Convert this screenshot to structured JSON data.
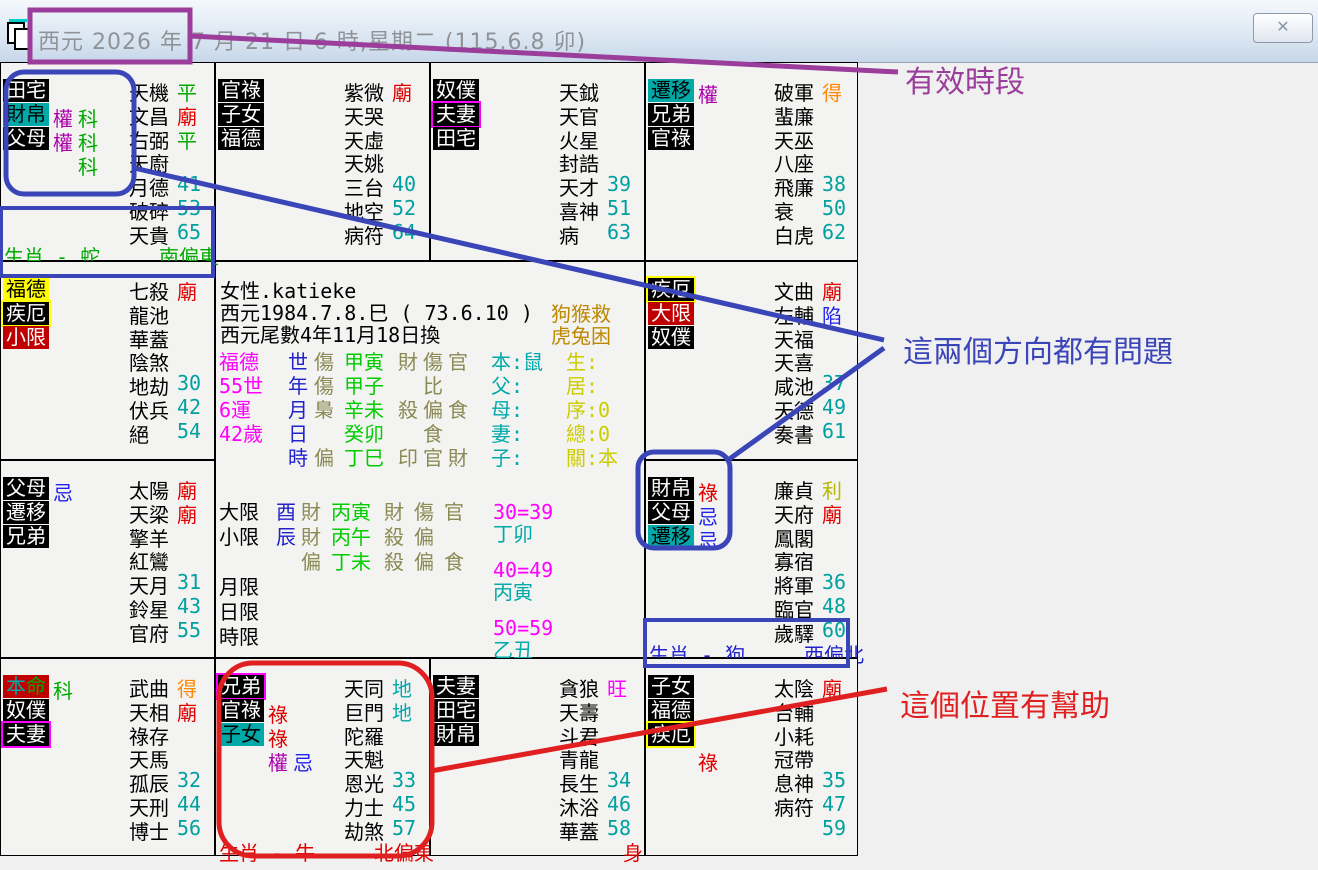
{
  "window": {
    "title": "西元 2026 年 7 月 21 日 6 時,星期二 (115.6.8 卯)",
    "close_label": "✕"
  },
  "annotations": {
    "valid_period": "有效時段",
    "directions_problem": "這兩個方向都有問題",
    "position_help": "這個位置有幫助"
  },
  "colors": {
    "badge_teal": "#00a8a8",
    "badge_red": "#c00000",
    "badge_yellow": "#ffff00",
    "temple_red": "#e00000",
    "wang_magenta": "#ff00ff",
    "de_orange": "#ff8800",
    "li_olive": "#b8b800",
    "ping_green": "#00aa00",
    "xian_blue": "#2222ee",
    "number_teal": "#00a0a0",
    "mark_lu": "#e00000",
    "mark_quan": "#aa00aa",
    "mark_ke": "#00aa00",
    "mark_ji": "#2222ee",
    "annotation_purple": "#9b3d9b",
    "annotation_blue": "#3a45b8",
    "annotation_red": "#e02020"
  },
  "palaces": [
    {
      "id": "si",
      "col": 0,
      "row": 0,
      "badges": [
        {
          "t": "田宅",
          "s": "black"
        },
        {
          "t": "財帛",
          "s": "teal"
        },
        {
          "t": "父母",
          "s": "black"
        }
      ],
      "marks": [
        [],
        [
          {
            "t": "權",
            "c": "pu",
            "col": 0
          },
          {
            "t": "科",
            "c": "gr",
            "col": 1
          }
        ],
        [
          {
            "t": "權",
            "c": "pu",
            "col": 0
          },
          {
            "t": "科",
            "c": "gr",
            "col": 1
          }
        ],
        [
          {
            "t": "科",
            "c": "gr",
            "col": 1
          }
        ]
      ],
      "stars": [
        {
          "n": "天機",
          "x": "平",
          "c": "gr"
        },
        {
          "n": "文昌",
          "x": "廟",
          "c": "re"
        },
        {
          "n": "右弼",
          "x": "平",
          "c": "gr"
        },
        {
          "n": "天廚"
        },
        {
          "n": "月德",
          "x": "41",
          "c": "nu"
        },
        {
          "n": "破碎",
          "x": "53",
          "c": "nu"
        },
        {
          "n": "天貴",
          "x": "65",
          "c": "nu"
        }
      ],
      "corner": {
        "left": "生肖 - 蛇",
        "right": "南偏東",
        "c": "gr"
      }
    },
    {
      "id": "wu",
      "col": 1,
      "row": 0,
      "badges": [
        {
          "t": "官祿",
          "s": "black"
        },
        {
          "t": "子女",
          "s": "black"
        },
        {
          "t": "福德",
          "s": "black"
        }
      ],
      "marks": [],
      "stars": [
        {
          "n": "紫微",
          "x": "廟",
          "c": "re"
        },
        {
          "n": "天哭"
        },
        {
          "n": "天虛"
        },
        {
          "n": "天姚"
        },
        {
          "n": "三台",
          "x": "40",
          "c": "nu"
        },
        {
          "n": "地空",
          "x": "52",
          "c": "nu"
        },
        {
          "n": "病符",
          "x": "64",
          "c": "nu"
        }
      ]
    },
    {
      "id": "wei",
      "col": 2,
      "row": 0,
      "badges": [
        {
          "t": "奴僕",
          "s": "black"
        },
        {
          "t": "夫妻",
          "s": "black-mb"
        },
        {
          "t": "田宅",
          "s": "black"
        }
      ],
      "marks": [],
      "stars": [
        {
          "n": "天鉞"
        },
        {
          "n": "天官"
        },
        {
          "n": "火星"
        },
        {
          "n": "封誥"
        },
        {
          "n": "天才",
          "x": "39",
          "c": "nu"
        },
        {
          "n": "喜神",
          "x": "51",
          "c": "nu"
        },
        {
          "n": "病",
          "x": "63",
          "c": "nu"
        }
      ]
    },
    {
      "id": "shen",
      "col": 3,
      "row": 0,
      "badges": [
        {
          "t": "遷移",
          "s": "teal"
        },
        {
          "t": "兄弟",
          "s": "black"
        },
        {
          "t": "官祿",
          "s": "black"
        }
      ],
      "marks": [
        [
          {
            "t": "權",
            "c": "pu",
            "col": 0
          }
        ]
      ],
      "stars": [
        {
          "n": "破軍",
          "x": "得",
          "c": "or"
        },
        {
          "n": "蜚廉"
        },
        {
          "n": "天巫"
        },
        {
          "n": "八座"
        },
        {
          "n": "飛廉",
          "x": "38",
          "c": "nu"
        },
        {
          "n": "衰",
          "x": "50",
          "c": "nu"
        },
        {
          "n": "白虎",
          "x": "62",
          "c": "nu"
        }
      ]
    },
    {
      "id": "chen",
      "col": 0,
      "row": 1,
      "badges": [
        {
          "t": "福德",
          "s": "yellow"
        },
        {
          "t": "疾厄",
          "s": "black-yb"
        },
        {
          "t": "小限",
          "s": "red"
        }
      ],
      "marks": [],
      "stars": [
        {
          "n": "七殺",
          "x": "廟",
          "c": "re"
        },
        {
          "n": "龍池"
        },
        {
          "n": "華蓋"
        },
        {
          "n": "陰煞"
        },
        {
          "n": "地劫",
          "x": "30",
          "c": "nu"
        },
        {
          "n": "伏兵",
          "x": "42",
          "c": "nu"
        },
        {
          "n": "絕",
          "x": "54",
          "c": "nu"
        }
      ]
    },
    {
      "id": "you",
      "col": 3,
      "row": 1,
      "badges": [
        {
          "t": "疾厄",
          "s": "black-yb"
        },
        {
          "t": "大限",
          "s": "red"
        },
        {
          "t": "奴僕",
          "s": "black"
        }
      ],
      "marks": [],
      "stars": [
        {
          "n": "文曲",
          "x": "廟",
          "c": "re"
        },
        {
          "n": "左輔",
          "x": "陷",
          "c": "bl"
        },
        {
          "n": "天福"
        },
        {
          "n": "天喜"
        },
        {
          "n": "咸池",
          "x": "37",
          "c": "nu"
        },
        {
          "n": "天德",
          "x": "49",
          "c": "nu"
        },
        {
          "n": "奏書",
          "x": "61",
          "c": "nu"
        }
      ]
    },
    {
      "id": "mao",
      "col": 0,
      "row": 2,
      "badges": [
        {
          "t": "父母",
          "s": "black"
        },
        {
          "t": "遷移",
          "s": "black"
        },
        {
          "t": "兄弟",
          "s": "black"
        }
      ],
      "marks": [
        [
          {
            "t": "忌",
            "c": "bl",
            "col": 0
          }
        ]
      ],
      "stars": [
        {
          "n": "太陽",
          "x": "廟",
          "c": "re"
        },
        {
          "n": "天梁",
          "x": "廟",
          "c": "re"
        },
        {
          "n": "擎羊"
        },
        {
          "n": "紅鸞"
        },
        {
          "n": "天月",
          "x": "31",
          "c": "nu"
        },
        {
          "n": "鈴星",
          "x": "43",
          "c": "nu"
        },
        {
          "n": "官府",
          "x": "55",
          "c": "nu"
        }
      ]
    },
    {
      "id": "xu",
      "col": 3,
      "row": 2,
      "badges": [
        {
          "t": "財帛",
          "s": "black"
        },
        {
          "t": "父母",
          "s": "black"
        },
        {
          "t": "遷移",
          "s": "teal"
        }
      ],
      "marks": [
        [
          {
            "t": "祿",
            "c": "re",
            "col": 0
          }
        ],
        [
          {
            "t": "忌",
            "c": "bl",
            "col": 0
          }
        ],
        [
          {
            "t": "忌",
            "c": "bl",
            "col": 0
          }
        ]
      ],
      "stars": [
        {
          "n": "廉貞",
          "x": "利",
          "c": "ol"
        },
        {
          "n": "天府",
          "x": "廟",
          "c": "re"
        },
        {
          "n": "鳳閣"
        },
        {
          "n": "寡宿"
        },
        {
          "n": "將軍",
          "x": "36",
          "c": "nu"
        },
        {
          "n": "臨官",
          "x": "48",
          "c": "nu"
        },
        {
          "n": "歲驛",
          "x": "60",
          "c": "nu"
        }
      ],
      "corner": {
        "left": "生肖 - 狗",
        "right": "西偏北",
        "c": "bc"
      }
    },
    {
      "id": "yin",
      "col": 0,
      "row": 3,
      "badges": [
        {
          "t": "本命",
          "s": "red",
          "chars": [
            {
              "t": "本",
              "c": "te"
            },
            {
              "t": "命",
              "c": "gr"
            }
          ]
        },
        {
          "t": "奴僕",
          "s": "black"
        },
        {
          "t": "夫妻",
          "s": "black-mb"
        }
      ],
      "marks": [
        [
          {
            "t": "科",
            "c": "gr",
            "col": 0
          }
        ]
      ],
      "stars": [
        {
          "n": "武曲",
          "x": "得",
          "c": "or"
        },
        {
          "n": "天相",
          "x": "廟",
          "c": "re"
        },
        {
          "n": "祿存"
        },
        {
          "n": "天馬"
        },
        {
          "n": "孤辰",
          "x": "32",
          "c": "nu"
        },
        {
          "n": "天刑",
          "x": "44",
          "c": "nu"
        },
        {
          "n": "博士",
          "x": "56",
          "c": "nu"
        }
      ]
    },
    {
      "id": "chou",
      "col": 1,
      "row": 3,
      "badges": [
        {
          "t": "兄弟",
          "s": "black-mb"
        },
        {
          "t": "官祿",
          "s": "black"
        },
        {
          "t": "子女",
          "s": "teal"
        }
      ],
      "marks": [
        [],
        [
          {
            "t": "祿",
            "c": "re",
            "col": 0
          }
        ],
        [
          {
            "t": "祿",
            "c": "re",
            "col": 0
          }
        ],
        [
          {
            "t": "權",
            "c": "pu",
            "col": 0
          },
          {
            "t": "忌",
            "c": "bl",
            "col": 1
          }
        ]
      ],
      "stars": [
        {
          "n": "天同",
          "x": "地",
          "c": "te"
        },
        {
          "n": "巨門",
          "x": "地",
          "c": "te"
        },
        {
          "n": "陀羅"
        },
        {
          "n": "天魁"
        },
        {
          "n": "恩光",
          "x": "33",
          "c": "nu"
        },
        {
          "n": "力士",
          "x": "45",
          "c": "nu"
        },
        {
          "n": "劫煞",
          "x": "57",
          "c": "nu"
        }
      ],
      "corner": {
        "left": "生肖 - 牛",
        "right": "北偏東",
        "c": "re"
      }
    },
    {
      "id": "zi",
      "col": 2,
      "row": 3,
      "badges": [
        {
          "t": "夫妻",
          "s": "black"
        },
        {
          "t": "田宅",
          "s": "black"
        },
        {
          "t": "財帛",
          "s": "black"
        }
      ],
      "marks": [],
      "stars": [
        {
          "n": "貪狼",
          "x": "旺",
          "c": "ma"
        },
        {
          "n": "天壽"
        },
        {
          "n": "斗君"
        },
        {
          "n": "青龍"
        },
        {
          "n": "長生",
          "x": "34",
          "c": "nu"
        },
        {
          "n": "沐浴",
          "x": "46",
          "c": "nu"
        },
        {
          "n": "華蓋",
          "x": "58",
          "c": "nu"
        }
      ],
      "corner": {
        "right": "身",
        "c": "re",
        "rx": 192
      }
    },
    {
      "id": "hai",
      "col": 3,
      "row": 3,
      "badges": [
        {
          "t": "子女",
          "s": "black"
        },
        {
          "t": "福德",
          "s": "black"
        },
        {
          "t": "疾厄",
          "s": "black-yb"
        }
      ],
      "marks": [
        [],
        [],
        [],
        [
          {
            "t": "祿",
            "c": "re",
            "col": 0
          }
        ]
      ],
      "stars": [
        {
          "n": "太陰",
          "x": "廟",
          "c": "re"
        },
        {
          "n": "台輔"
        },
        {
          "n": "小耗"
        },
        {
          "n": "冠帶"
        },
        {
          "n": "息神",
          "x": "35",
          "c": "nu"
        },
        {
          "n": "病符",
          "x": "47",
          "c": "nu"
        },
        {
          "n": "",
          "x": "59",
          "c": "nu"
        }
      ]
    }
  ],
  "center": {
    "name_line": "女性.katieke",
    "birth_line": "西元1984.7.8.巳 ( 73.6.10 )",
    "birth_side": "狗猴救",
    "swap_line": "西元尾數4年11月18日換",
    "swap_side": "虎兔困",
    "pillars": [
      [
        "福德",
        "世",
        "傷",
        "甲寅",
        "財傷官",
        "本:鼠",
        "生:"
      ],
      [
        "55世",
        "年",
        "傷",
        "甲子",
        "　比",
        "父:",
        "居:"
      ],
      [
        "6運",
        "月",
        "梟",
        "辛未",
        "殺偏食",
        "母:",
        "序:0"
      ],
      [
        "42歲",
        "日",
        "",
        "癸卯",
        "　食",
        "妻:",
        "總:0"
      ],
      [
        "",
        "時",
        "偏",
        "丁巳",
        "印官財",
        "子:",
        "關:本"
      ]
    ],
    "limits": [
      [
        "大限",
        "酉",
        "財",
        "丙寅",
        "財傷官"
      ],
      [
        "小限",
        "辰",
        "財",
        "丙午",
        "殺偏"
      ],
      [
        "",
        "",
        "偏",
        "丁未",
        "殺偏食"
      ],
      [
        "月限",
        "",
        "",
        "",
        ""
      ],
      [
        "日限",
        "",
        "",
        "",
        ""
      ],
      [
        "時限",
        "",
        "",
        "",
        ""
      ]
    ],
    "decades": [
      {
        "range": "30=39",
        "gz": "丁卯"
      },
      {
        "range": "40=49",
        "gz": "丙寅"
      },
      {
        "range": "50=59",
        "gz": "乙丑"
      }
    ]
  }
}
